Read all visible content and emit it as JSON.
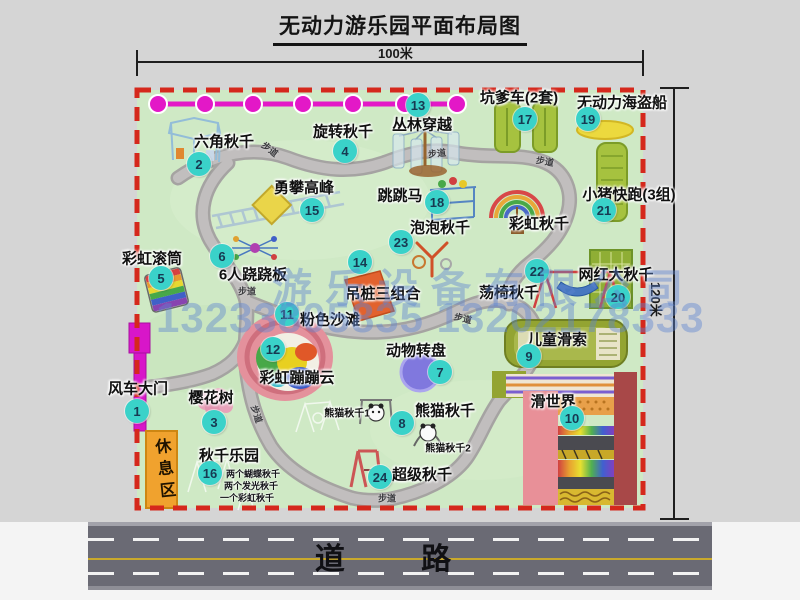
{
  "title": "无动力游乐园平面布局图",
  "dims": {
    "top": "100米",
    "right": "120米"
  },
  "road": "道 路",
  "walkway": "步道",
  "rest_area": "休息区",
  "watermark": {
    "company": "游乐设备有限公司",
    "phone": "13233805835 13202178333"
  },
  "markers": [
    {
      "num": "1",
      "label": "风车大门"
    },
    {
      "num": "2",
      "label": "六角秋千"
    },
    {
      "num": "3",
      "label": "樱花树"
    },
    {
      "num": "4",
      "label": "旋转秋千"
    },
    {
      "num": "5",
      "label": "彩虹滚筒"
    },
    {
      "num": "6",
      "label": "6人跷跷板"
    },
    {
      "num": "7",
      "label": "动物转盘"
    },
    {
      "num": "8",
      "label": "熊猫秋千"
    },
    {
      "num": "9",
      "label": "儿童滑索"
    },
    {
      "num": "10",
      "label": "滑世界"
    },
    {
      "num": "11",
      "label": "粉色沙滩"
    },
    {
      "num": "12",
      "label": "彩虹蹦蹦云"
    },
    {
      "num": "13",
      "label": "丛林穿越"
    },
    {
      "num": "14",
      "label": "吊桩三组合"
    },
    {
      "num": "15",
      "label": "勇攀高峰"
    },
    {
      "num": "16",
      "label": "秋千乐园"
    },
    {
      "num": "17",
      "label": "坑爹车(2套)"
    },
    {
      "num": "18",
      "label": "跳跳马"
    },
    {
      "num": "19",
      "label": "无动力海盗船"
    },
    {
      "num": "20",
      "label": "网红大秋千"
    },
    {
      "num": "21",
      "label": "小猪快跑(3组)"
    },
    {
      "num": "22",
      "label": "荡椅秋千"
    },
    {
      "num": "23",
      "label": "泡泡秋千"
    },
    {
      "num": "24",
      "label": "超级秋千"
    }
  ],
  "extra": {
    "rainbow_swing": "彩虹秋千",
    "panda_swing_1": "熊猫秋千1",
    "panda_swing_2": "熊猫秋千2",
    "swing_note_1": "两个蝴蝶秋千",
    "swing_note_2": "两个发光秋千",
    "swing_note_3": "一个彩虹秋千"
  },
  "colors": {
    "marker_cyan": "#3ad2c9",
    "boundary_red": "#d5281c",
    "park_green": "#cfe9c5",
    "zipline_magenta": "#e318c7",
    "gate_magenta": "#d816c9",
    "rest_area_orange": "#f0a22e",
    "road_gray": "#6a6a74",
    "watermark_blue": "#5c85d0"
  }
}
